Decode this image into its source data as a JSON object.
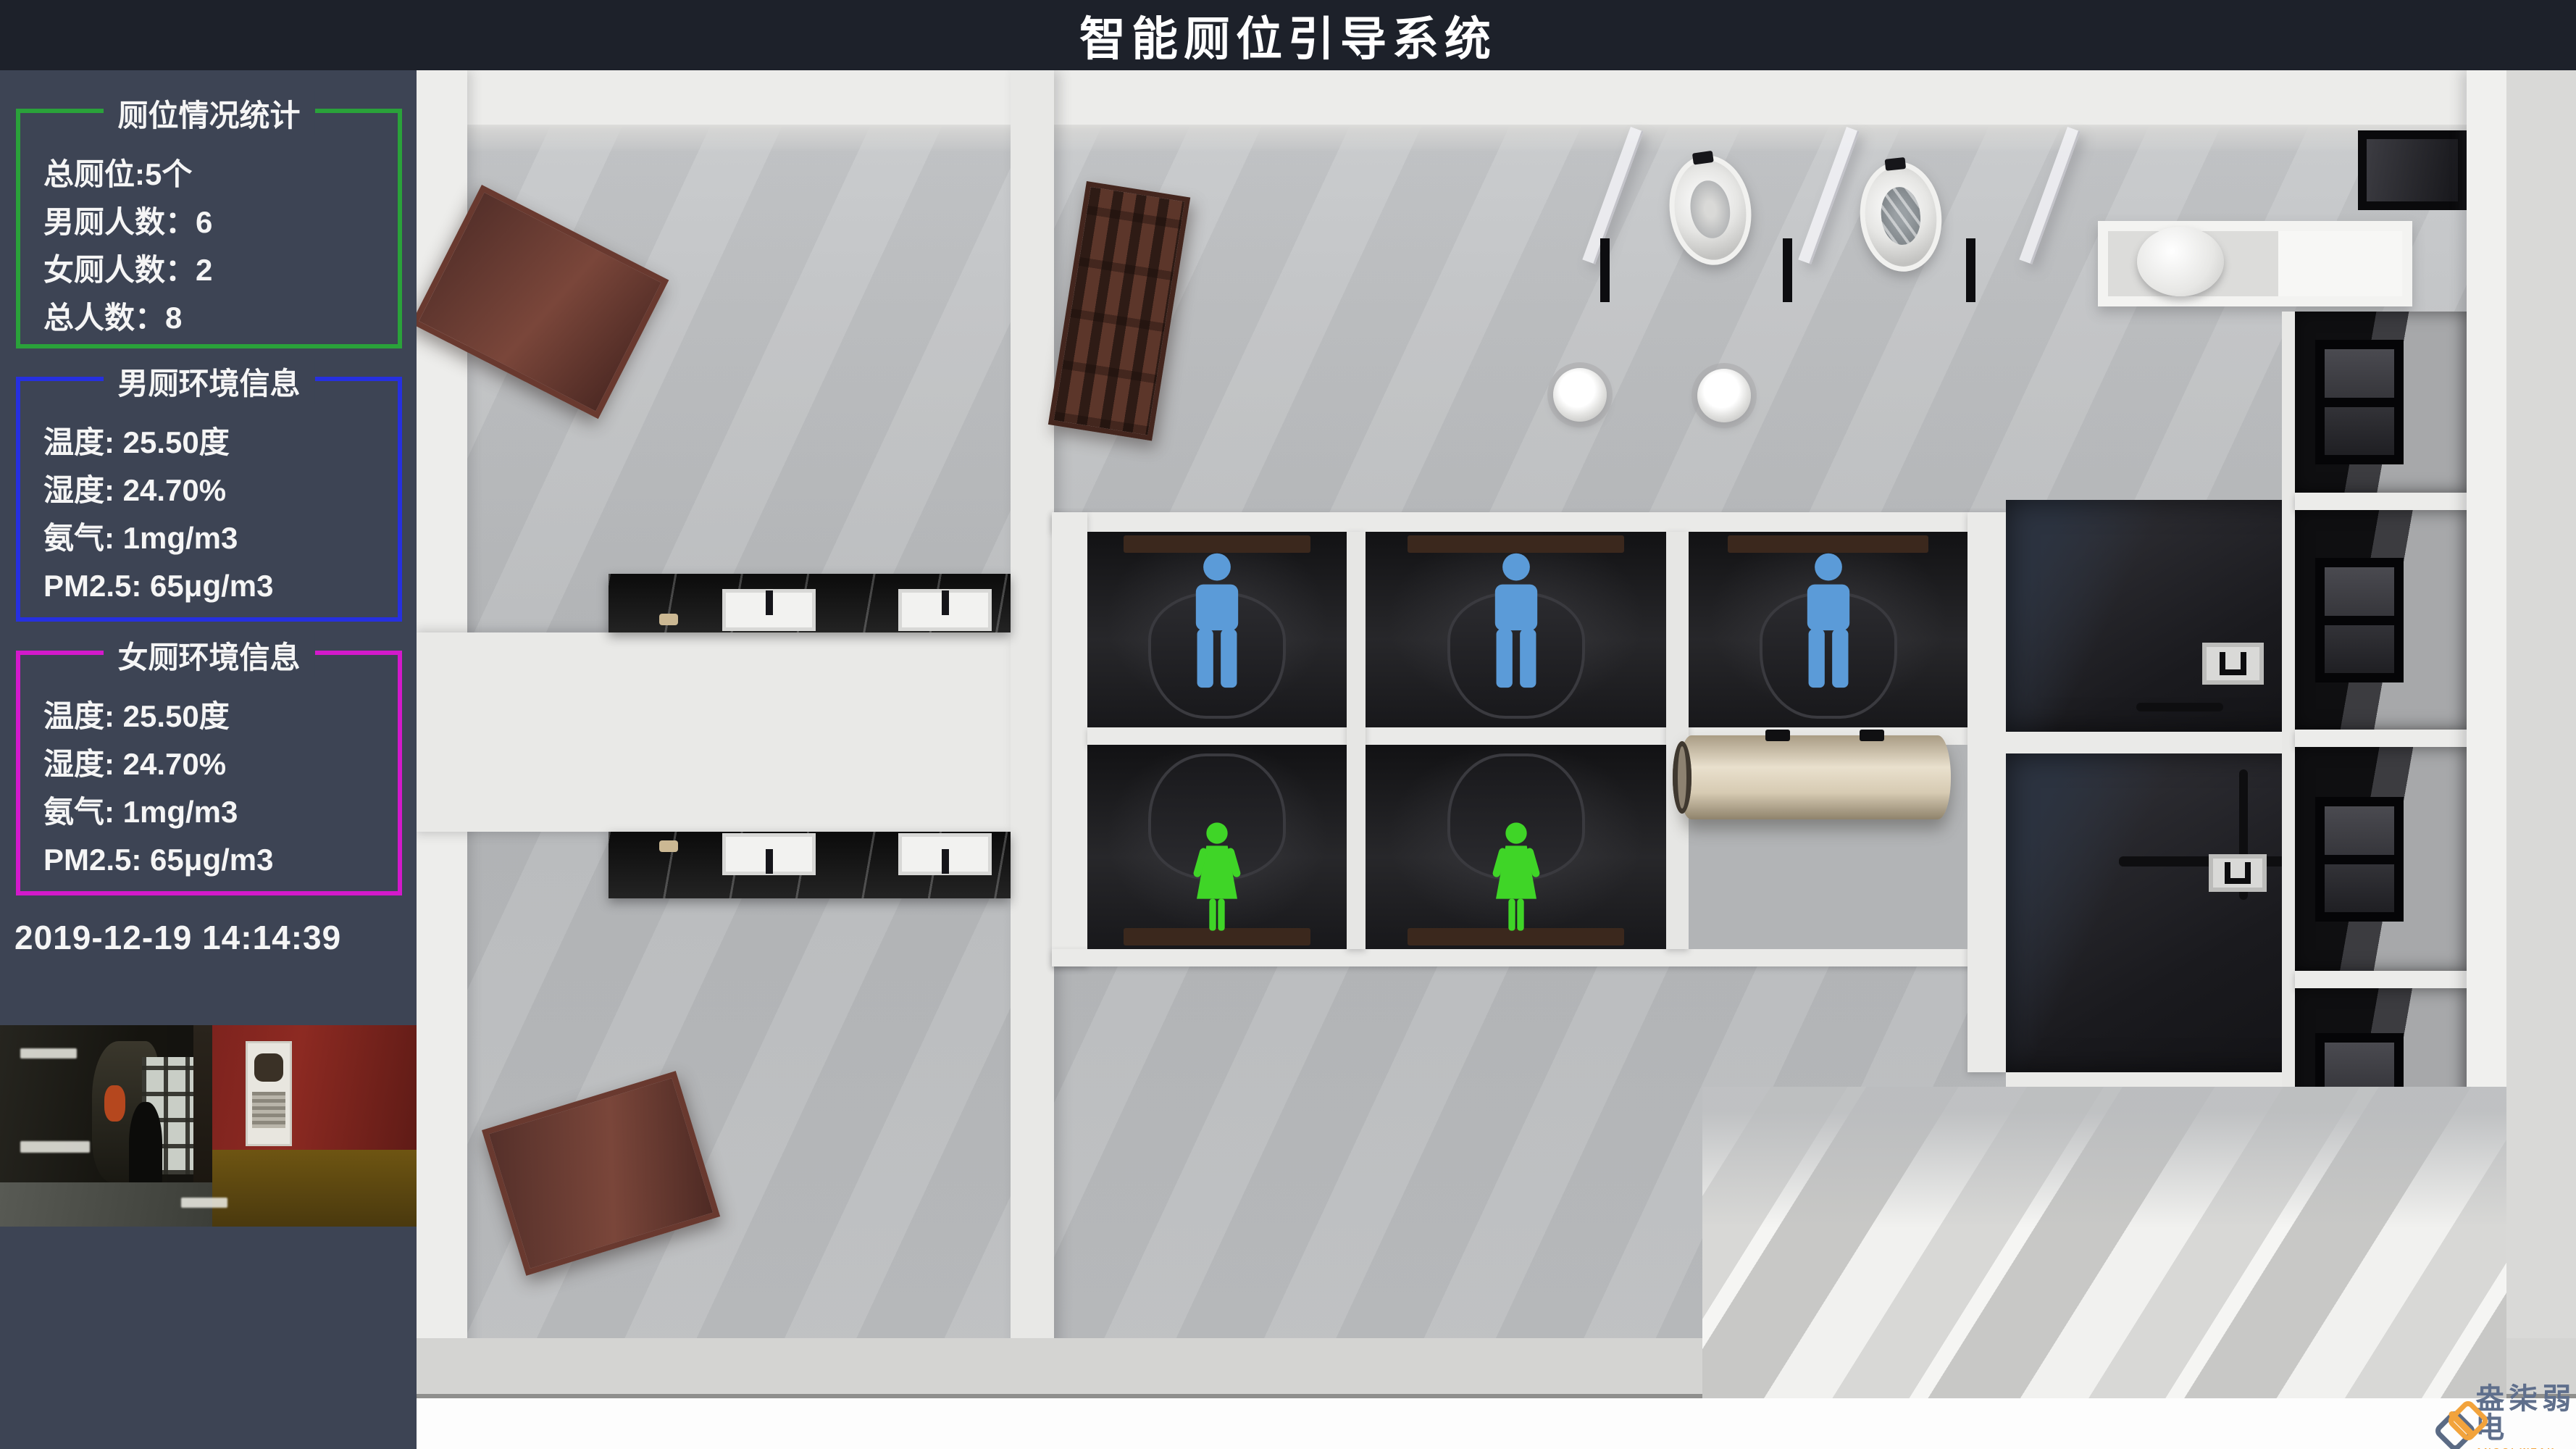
{
  "header": {
    "title": "智能厕位引导系统"
  },
  "sidebar": {
    "stats_panel": {
      "title": "厕位情况统计",
      "border_color": "#2aa23a",
      "lines": [
        "总厕位:5个",
        "男厕人数：6",
        "女厕人数：2",
        "总人数：8"
      ]
    },
    "male_env_panel": {
      "title": "男厕环境信息",
      "border_color": "#2630e0",
      "lines": [
        "温度: 25.50度",
        "湿度: 24.70%",
        "氨气: 1mg/m3",
        "PM2.5: 65μg/m3"
      ]
    },
    "female_env_panel": {
      "title": "女厕环境信息",
      "border_color": "#d319cb",
      "lines": [
        "温度: 25.50度",
        "湿度: 24.70%",
        "氨气: 1mg/m3",
        "PM2.5: 65μg/m3"
      ]
    },
    "timestamp": "2019-12-19 14:14:39"
  },
  "values": {
    "total_stalls": 5,
    "male_count": 6,
    "female_count": 2,
    "total_people": 8,
    "temperature": "25.50",
    "humidity": "24.70",
    "ammonia": "1",
    "pm25": "65"
  },
  "scene": {
    "male_icon_color": "#5b9bd8",
    "female_icon_color": "#3fd527",
    "stalls": [
      {
        "id": 1,
        "row": "top",
        "occupant": "male"
      },
      {
        "id": 2,
        "row": "top",
        "occupant": "male"
      },
      {
        "id": 3,
        "row": "top",
        "occupant": "male"
      },
      {
        "id": 4,
        "row": "bottom",
        "occupant": "female"
      },
      {
        "id": 5,
        "row": "bottom",
        "occupant": "female"
      }
    ]
  },
  "logo": {
    "name": "盎柒弱电",
    "subtitle": "ANGQI WEAK ELECTRICITY",
    "colors": {
      "primary": "#f2a33c",
      "secondary": "#5a6a84"
    }
  }
}
